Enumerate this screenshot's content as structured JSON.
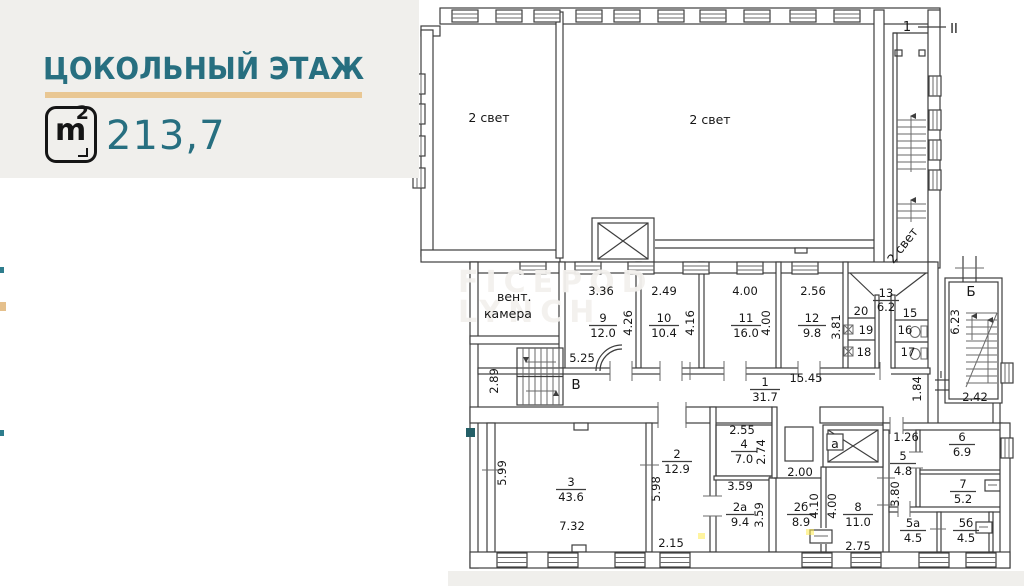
{
  "header": {
    "title": "ЦОКОЛЬНЫЙ ЭТАЖ",
    "area": "213,7",
    "unit_m": "m",
    "unit_sup": "2"
  },
  "watermark": {
    "line1": "FICEPOD",
    "line2": "LYNCH"
  },
  "labels": {
    "light_left": "2 свет",
    "light_right": "2 свет",
    "light_stair": "2 свет",
    "vent1": "вент.",
    "vent2": "камера",
    "stair_top_num": "1",
    "section_mark": "II",
    "stair_b": "Б",
    "stair_v": "В",
    "elevator_a": "а",
    "mark_i": "I"
  },
  "rooms": {
    "r1": {
      "num": "1",
      "area": "31.7"
    },
    "r2": {
      "num": "2",
      "area": "12.9"
    },
    "r2a": {
      "num": "2а",
      "area": "9.4"
    },
    "r2b": {
      "num": "2б",
      "area": "8.9"
    },
    "r3": {
      "num": "3",
      "area": "43.6"
    },
    "r4": {
      "num": "4",
      "area": "7.0"
    },
    "r5": {
      "num": "5",
      "area": "4.8"
    },
    "r5a": {
      "num": "5а",
      "area": "4.5"
    },
    "r5b": {
      "num": "5б",
      "area": "4.5"
    },
    "r6": {
      "num": "6",
      "area": "6.9"
    },
    "r7": {
      "num": "7",
      "area": "5.2"
    },
    "r8": {
      "num": "8",
      "area": "11.0"
    },
    "r9": {
      "num": "9",
      "area": "12.0"
    },
    "r10": {
      "num": "10",
      "area": "10.4"
    },
    "r11": {
      "num": "11",
      "area": "16.0"
    },
    "r12": {
      "num": "12",
      "area": "9.8"
    },
    "r13": {
      "num": "13",
      "area": "6.2"
    }
  },
  "cells": {
    "c15": "15",
    "c16": "16",
    "c17": "17",
    "c18": "18",
    "c19": "19",
    "c20": "20"
  },
  "dims": {
    "t9": "3.36",
    "t10": "2.49",
    "t11": "4.00",
    "t12": "2.56",
    "s9": "4.26",
    "s10": "4.16",
    "s11": "4.00",
    "s12": "3.81",
    "corr_w": "15.45",
    "corr_h": "1.84",
    "sb_h": "6.23",
    "sb_w": "2.42",
    "sv_w": "5.25",
    "sv_h": "2.89",
    "r3_h": "5.99",
    "r3_w": "7.32",
    "r2_h": "5.98",
    "r2_w": "2.15",
    "r4_t": "2.55",
    "r4_s": "2.74",
    "r2b_t": "2.00",
    "r2b_s": "4.10",
    "r2a_t": "3.59",
    "r2a_s": "3.59",
    "r8_s": "4.00",
    "r8_b": "2.75",
    "r5_t": "1.26",
    "r5_s": "3.80"
  }
}
